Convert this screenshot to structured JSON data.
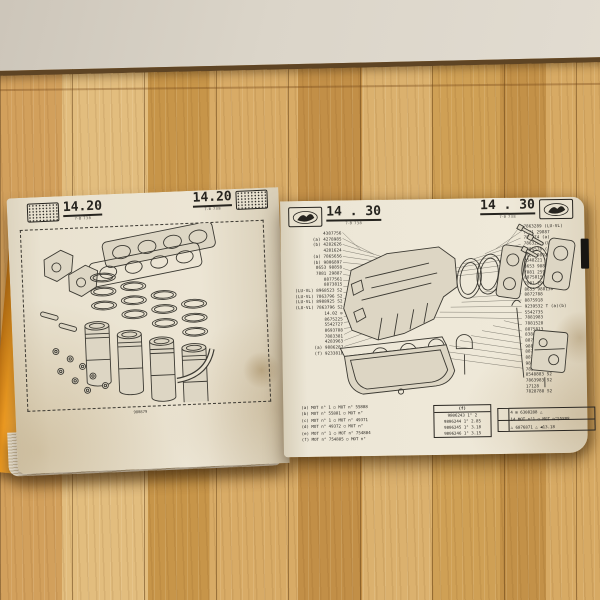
{
  "scene": {
    "wall_color": "#dbd5c9",
    "floor_color": "#d2a05c",
    "cover_color": "#ef9c22",
    "page_color": "#ece5d4"
  },
  "left_page": {
    "page_ref": "14.20",
    "page_ref_sub": "7-B 738",
    "caption": "980879"
  },
  "right_page": {
    "page_ref": "14 . 30",
    "page_ref_sub": "7-B 738",
    "left_parts": [
      "4387756",
      "(a) 4278985",
      "(b) 4282626",
      "4281624",
      "(a) 7865656",
      "(b) 9806897",
      "8653 98858",
      "7881 29887",
      "8877561",
      "8873815",
      "(LU-VL) 8968523 S2",
      "(LU-VL) 7863796 S2",
      "(LU-VL) 8988925 S2",
      "(LU-VL) 7863796 S2",
      "14.02 ⊙",
      "8675225",
      "5542727",
      "8693788",
      "7883381",
      "4283963",
      "(a) 9886287",
      "(f) 9233818"
    ],
    "right_parts": [
      "7863289 (LU-VL)",
      "7881 29887",
      "788774 (a)",
      "7863288 (LU-VL)",
      "9806578 (a)",
      "8653 989292",
      "2548221 (a)",
      "8653 98812B",
      "7881 25989",
      "8875815",
      "7881 29882",
      "8653 988138",
      "8872788",
      "8875918",
      "9239532 T (a)(b)",
      "5542735",
      "7881983",
      "7881528",
      "8875813",
      "8388288 (a)",
      "8871824 S2",
      "988858A",
      "8877845",
      "8876965",
      "9887155",
      "7829787",
      "8548883 S2",
      "7863983 S2",
      "17128",
      "7828788 S2"
    ],
    "notes": [
      "(a) MOT n°      1 ○ MOT n° 55888",
      "(b) MOT n° 55881 ○ MOT n°",
      "(c) MOT n°      1 ○ MOT n° 49371",
      "(d) MOT n° 49372 ○ MOT n°",
      "(e) MOT n°      1 ○ MOT n° 754884",
      "(f) MOT n° 754885 ○ MOT n°"
    ],
    "size_table": {
      "header": "(f)",
      "rows": [
        "9806243 1° 2",
        "9806244 1° 2.85",
        "9806245 1° 3.18",
        "9806246 1° 3.15"
      ]
    },
    "app_table": {
      "rows": [
        "4  ⊞ 6308288 △",
        "14 MOT n°1 ○ MOT n°55888",
        "   △ 6876871 △ ◀13.18"
      ]
    }
  }
}
